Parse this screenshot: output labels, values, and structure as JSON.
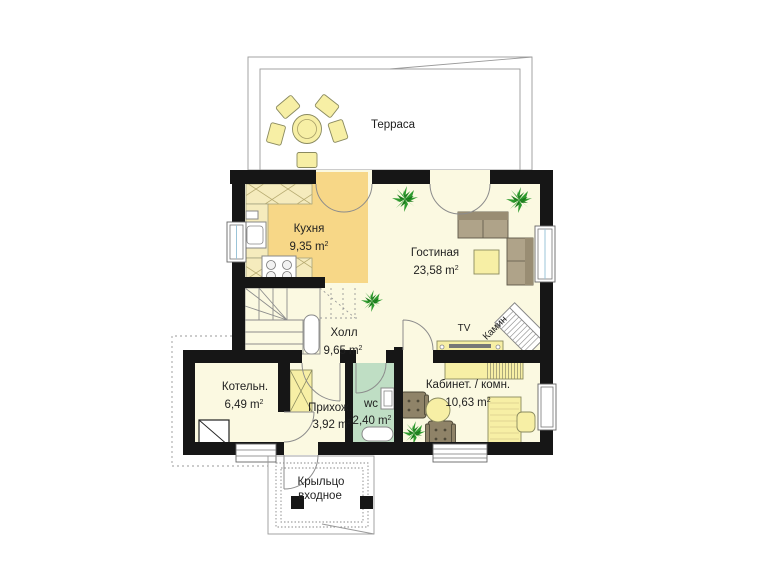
{
  "plan": {
    "terrace_label": "Терраса",
    "rooms": [
      {
        "key": "kitchen",
        "name": "Кухня",
        "area": "9,35"
      },
      {
        "key": "living",
        "name": "Гостиная",
        "area": "23,58"
      },
      {
        "key": "hall",
        "name": "Холл",
        "area": "9,65"
      },
      {
        "key": "boiler",
        "name": "Котельн.",
        "area": "6,49"
      },
      {
        "key": "entry",
        "name": "Прихож.",
        "area": "3,92"
      },
      {
        "key": "wc",
        "name": "wc",
        "area": "2,40"
      },
      {
        "key": "office",
        "name": "Кабинет. / комн.",
        "area": "10,63"
      }
    ],
    "annotations": {
      "tv": "TV",
      "fireplace": "Камин",
      "porch_line1": "Крыльцо",
      "porch_line2": "входное"
    },
    "units": {
      "unit": "m",
      "sup": "2"
    },
    "colors": {
      "wall": "#161616",
      "floor": "#FBF9E1",
      "kitchen_floor": "#F7D787",
      "wc_floor": "#BFDEC4",
      "counter": "#F5EBBD",
      "furniture_yellow": "#F7EFA5",
      "sofa": "#AFA389",
      "sofa_dark": "#998D73",
      "armchair": "#8F8368",
      "plant": "#2E9B2E",
      "line": "#8C8C8C"
    }
  }
}
